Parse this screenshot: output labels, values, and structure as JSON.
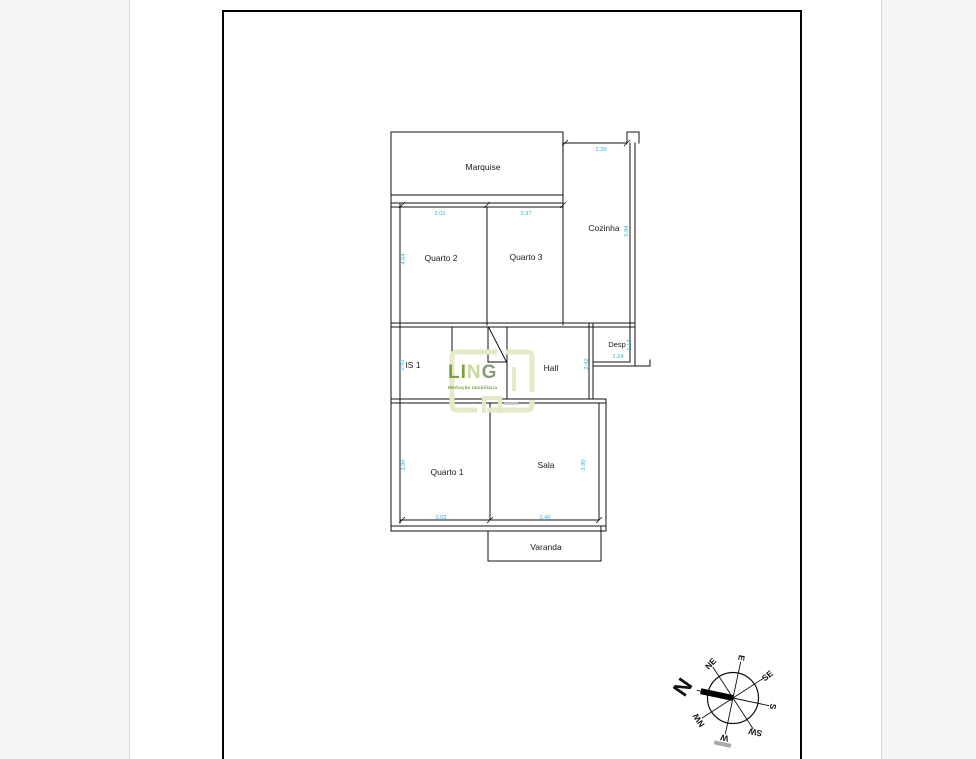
{
  "page": {
    "background": "#f4f4f4",
    "paper_color": "#ffffff",
    "frame_color": "#000000"
  },
  "floor_plan": {
    "line_color": "#111111",
    "dimension_color": "#2eb9cf",
    "rooms": [
      {
        "name": "Marquise",
        "x": 483,
        "y": 170
      },
      {
        "name": "Cozinha",
        "x": 604,
        "y": 231
      },
      {
        "name": "Quarto 2",
        "x": 441,
        "y": 261
      },
      {
        "name": "Quarto 3",
        "x": 526,
        "y": 260
      },
      {
        "name": "IS 1",
        "x": 413,
        "y": 368
      },
      {
        "name": "Hall",
        "x": 551,
        "y": 371
      },
      {
        "name": "Desp",
        "x": 617,
        "y": 347
      },
      {
        "name": "Quarto 1",
        "x": 447,
        "y": 475
      },
      {
        "name": "Sala",
        "x": 546,
        "y": 468
      },
      {
        "name": "Varanda",
        "x": 546,
        "y": 550
      }
    ],
    "dimensions": [
      {
        "value": "2.39",
        "x": 601,
        "y": 151,
        "rot": 0
      },
      {
        "value": "3.02",
        "x": 440,
        "y": 215,
        "rot": 0
      },
      {
        "value": "2.37",
        "x": 526,
        "y": 215,
        "rot": 0
      },
      {
        "value": "5.94",
        "x": 628,
        "y": 231,
        "rot": -90
      },
      {
        "value": "4.04",
        "x": 405,
        "y": 259,
        "rot": -90
      },
      {
        "value": "2.42",
        "x": 404,
        "y": 365,
        "rot": -90
      },
      {
        "value": "2.42",
        "x": 588,
        "y": 364,
        "rot": -90
      },
      {
        "value": "1.13",
        "x": 631,
        "y": 345,
        "rot": -90
      },
      {
        "value": "1.24",
        "x": 618,
        "y": 358,
        "rot": 0
      },
      {
        "value": "3.90",
        "x": 405,
        "y": 465,
        "rot": -90
      },
      {
        "value": "3.90",
        "x": 585,
        "y": 465,
        "rot": -90
      },
      {
        "value": "3.02",
        "x": 441,
        "y": 519,
        "rot": 0
      },
      {
        "value": "3.46",
        "x": 545,
        "y": 519,
        "rot": 0
      }
    ]
  },
  "logo": {
    "letters": [
      {
        "ch": "L",
        "color": "#7aa23c"
      },
      {
        "ch": "I",
        "color": "#7aa23c"
      },
      {
        "ch": "N",
        "color": "#ccd79f"
      },
      {
        "ch": "G",
        "color": "#84997e"
      }
    ],
    "tagline": "Mediação Imobiliária",
    "tagline_color": "#7aa23c",
    "frame_color": "#e5e9c6"
  },
  "compass": {
    "rotation": -78,
    "needle_color": "#000000",
    "directions": [
      {
        "label": "N",
        "angle": 0,
        "rot": -55,
        "big": true
      },
      {
        "label": "NE",
        "angle": 45,
        "rot": -48,
        "big": false
      },
      {
        "label": "E",
        "angle": 90,
        "rot": 100,
        "big": false
      },
      {
        "label": "SE",
        "angle": 135,
        "rot": -38,
        "big": false
      },
      {
        "label": "S",
        "angle": 180,
        "rot": 100,
        "big": false
      },
      {
        "label": "SW",
        "angle": 225,
        "rot": 192,
        "big": false
      },
      {
        "label": "W",
        "angle": 270,
        "rot": 192,
        "big": false
      },
      {
        "label": "NW",
        "angle": 315,
        "rot": 237,
        "big": false
      }
    ]
  }
}
